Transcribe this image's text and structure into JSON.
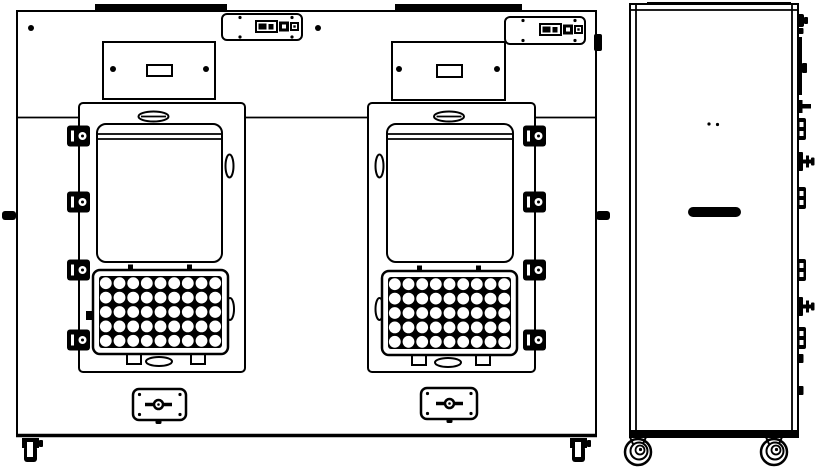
{
  "diagram": {
    "type": "technical-drawing",
    "colors": {
      "line": "#000000",
      "background": "#ffffff"
    },
    "front_view": {
      "doors": [
        "left",
        "right"
      ],
      "hole_grid": {
        "rows": 5,
        "cols": 9,
        "hole_radius": 5.9
      },
      "plates": [
        {
          "door": "left",
          "x": 99,
          "y": 276,
          "w": 123,
          "h": 72
        },
        {
          "door": "right",
          "x": 388,
          "y": 277,
          "w": 123,
          "h": 72
        }
      ],
      "hinges": {
        "y_centers": [
          136,
          202,
          270,
          340
        ],
        "doors": [
          {
            "door": "left",
            "x": 67
          },
          {
            "door": "right",
            "x": 523
          }
        ]
      }
    },
    "side_view": {
      "fittings": [
        {
          "type": "knob",
          "y": 14
        },
        {
          "type": "tab",
          "y": 28,
          "h": 6
        },
        {
          "type": "strip",
          "y": 37,
          "h": 58
        },
        {
          "type": "bracket",
          "y": 100
        },
        {
          "type": "hinge",
          "y": 118
        },
        {
          "type": "crossknob",
          "y": 152
        },
        {
          "type": "hinge",
          "y": 187
        },
        {
          "type": "hinge",
          "y": 259
        },
        {
          "type": "crossknob",
          "y": 297
        },
        {
          "type": "hinge",
          "y": 327
        },
        {
          "type": "tab",
          "y": 354,
          "h": 9
        },
        {
          "type": "tab",
          "y": 386,
          "h": 9
        }
      ],
      "casters": [
        {
          "cx": 638,
          "cy": 452
        },
        {
          "cx": 774,
          "cy": 452
        }
      ]
    }
  }
}
